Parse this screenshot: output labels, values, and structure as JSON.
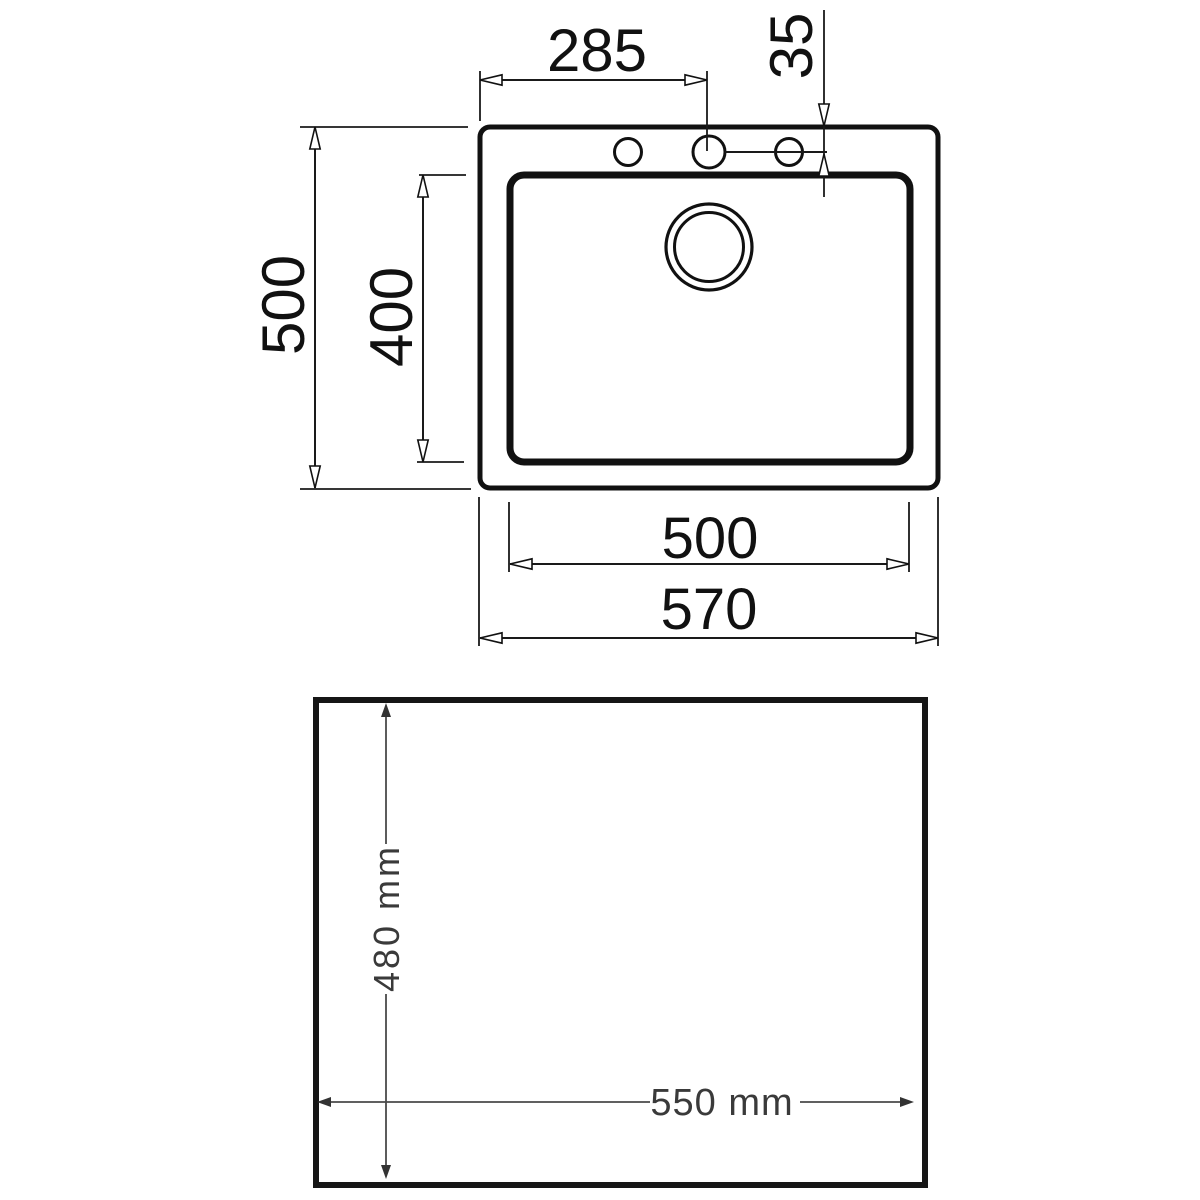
{
  "page": {
    "background": "#ffffff",
    "line_color": "#111111",
    "cutout_dim_color": "#3a3a3a"
  },
  "top_view": {
    "description": "sink plan view with outer rim, inner bowl, three faucet holes and drain",
    "dimensions": {
      "tap_holes_span": {
        "label": "285"
      },
      "tap_hole_offset": {
        "label": "35"
      },
      "overall_depth": {
        "label": "500"
      },
      "bowl_depth": {
        "label": "400"
      },
      "bowl_width": {
        "label": "500"
      },
      "overall_width": {
        "label": "570"
      }
    }
  },
  "cutout_view": {
    "description": "worktop cutout square",
    "dimensions": {
      "cutout_depth": {
        "label": "480 mm"
      },
      "cutout_width": {
        "label": "550 mm"
      }
    }
  }
}
